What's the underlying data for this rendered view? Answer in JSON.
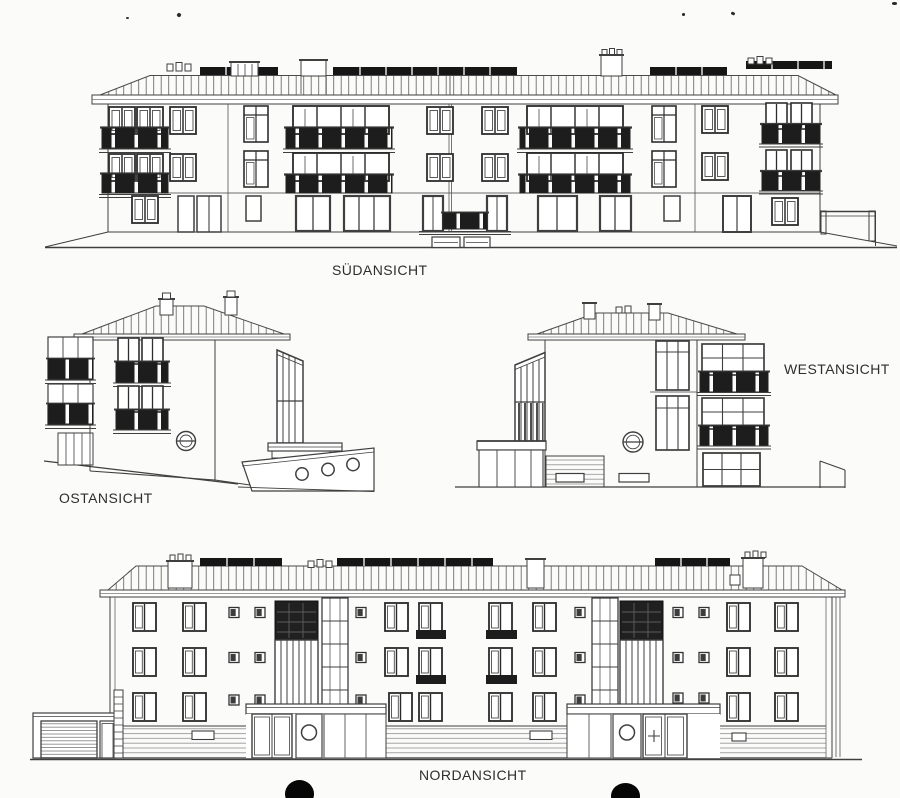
{
  "page": {
    "background_color": "#fbfbfa",
    "line_color": "#3f3f3f",
    "dark_fill_color": "#1d1d1d"
  },
  "elevations": {
    "south": {
      "label": "SÜDANSICHT"
    },
    "east": {
      "label": "OSTANSICHT"
    },
    "west": {
      "label": "WESTANSICHT"
    },
    "north": {
      "label": "NORDANSICHT"
    }
  }
}
